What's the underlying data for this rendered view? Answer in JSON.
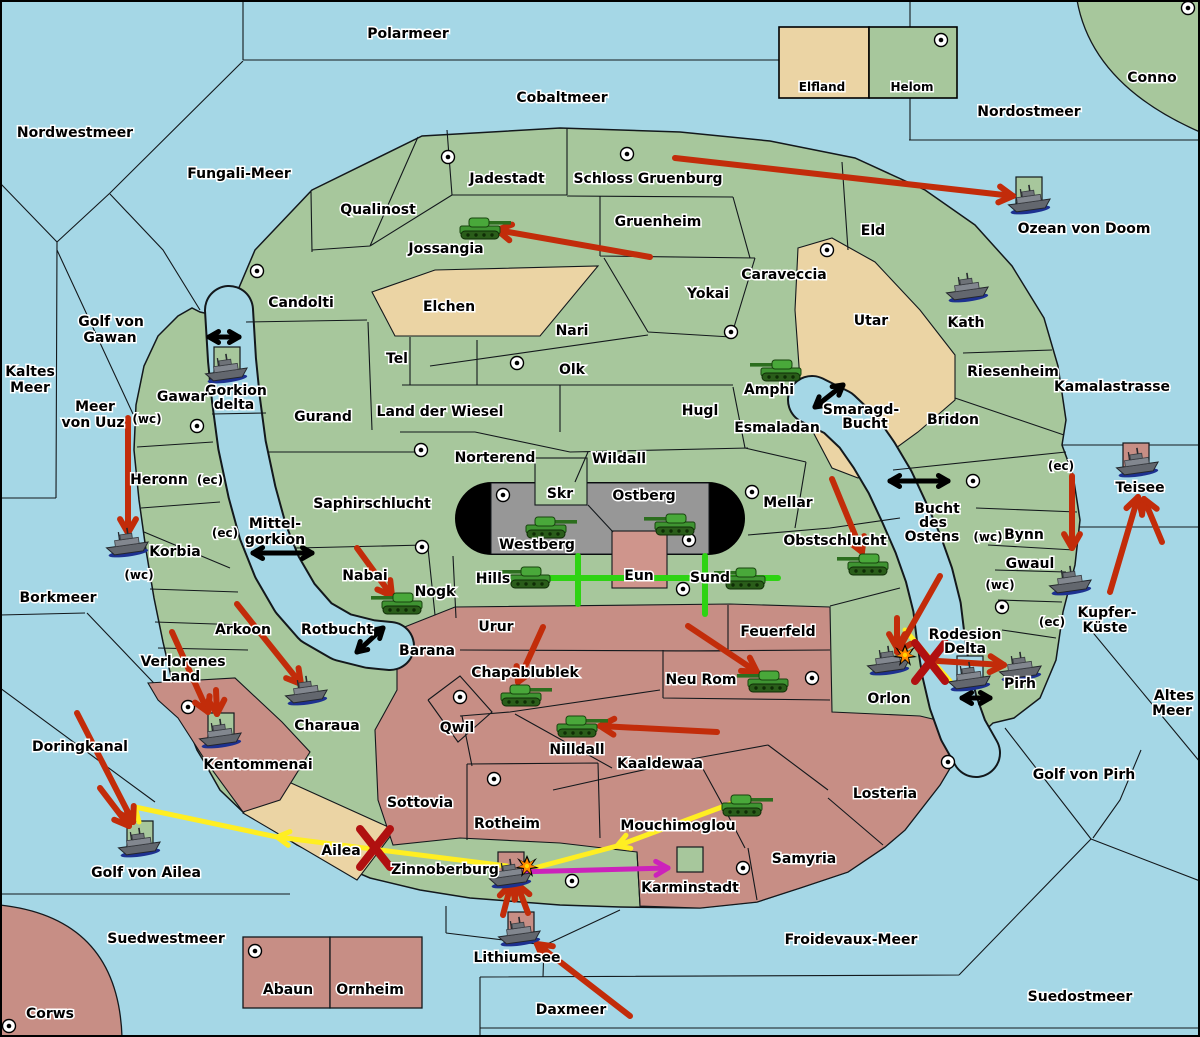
{
  "map_name": "territory-war-map",
  "colors": {
    "sea": "#a5d7e6",
    "land": "#a7c79c",
    "tan": "#ebd4a4",
    "pink": "#c78e85",
    "gray": "#979797",
    "eun": "#cf958c",
    "black": "#000000",
    "red_arrow": "#c22c0a",
    "dark_red": "#b01010",
    "yellow": "#ffee22",
    "magenta": "#cc22bb",
    "green_line": "#2ed313",
    "explosion": "#ff8800"
  },
  "legend": {
    "items": [
      {
        "label": "Elfland",
        "color": "#ebd4a4"
      },
      {
        "label": "Helom",
        "color": "#a7c79c",
        "has_marker": true
      }
    ]
  },
  "labels": [
    {
      "n": "polarmeer",
      "t": "Polarmeer",
      "x": 408,
      "y": 38
    },
    {
      "n": "nordwestmeer",
      "t": "Nordwestmeer",
      "x": 75,
      "y": 137
    },
    {
      "n": "cobaltmeer",
      "t": "Cobaltmeer",
      "x": 562,
      "y": 102
    },
    {
      "n": "nordostmeer",
      "t": "Nordostmeer",
      "x": 1029,
      "y": 116
    },
    {
      "n": "conno",
      "t": "Conno",
      "x": 1152,
      "y": 82
    },
    {
      "n": "fungali-meer",
      "t": "Fungali-Meer",
      "x": 239,
      "y": 178
    },
    {
      "n": "ozean-von-doom",
      "t": "Ozean von Doom",
      "x": 1084,
      "y": 233
    },
    {
      "n": "golf-von-gawan-1",
      "t": "Golf von",
      "x": 111,
      "y": 326
    },
    {
      "n": "golf-von-gawan-2",
      "t": "Gawan",
      "x": 110,
      "y": 342
    },
    {
      "n": "kaltes-meer-1",
      "t": "Kaltes",
      "x": 30,
      "y": 376
    },
    {
      "n": "kaltes-meer-2",
      "t": "Meer",
      "x": 30,
      "y": 392
    },
    {
      "n": "meer-von-uuz-1",
      "t": "Meer",
      "x": 95,
      "y": 411
    },
    {
      "n": "meer-von-uuz-2",
      "t": "von Uuz",
      "x": 93,
      "y": 427
    },
    {
      "n": "borkmeer",
      "t": "Borkmeer",
      "x": 58,
      "y": 602
    },
    {
      "n": "mittelgorkion-1",
      "t": "Mittel-",
      "x": 275,
      "y": 528
    },
    {
      "n": "mittelgorkion-2",
      "t": "gorkion",
      "x": 275,
      "y": 544
    },
    {
      "n": "rotbucht",
      "t": "Rotbucht",
      "x": 337,
      "y": 634
    },
    {
      "n": "doringkanal",
      "t": "Doringkanal",
      "x": 80,
      "y": 751
    },
    {
      "n": "golf-von-ailea",
      "t": "Golf von Ailea",
      "x": 146,
      "y": 877
    },
    {
      "n": "suedwestmeer",
      "t": "Suedwestmeer",
      "x": 166,
      "y": 943
    },
    {
      "n": "corws",
      "t": "Corws",
      "x": 50,
      "y": 1018
    },
    {
      "n": "suedostmeer",
      "t": "Suedostmeer",
      "x": 1080,
      "y": 1001
    },
    {
      "n": "froidevaux-meer",
      "t": "Froidevaux-Meer",
      "x": 851,
      "y": 944
    },
    {
      "n": "daxmeer",
      "t": "Daxmeer",
      "x": 571,
      "y": 1014
    },
    {
      "n": "lithiumsee",
      "t": "Lithiumsee",
      "x": 517,
      "y": 962
    },
    {
      "n": "kamalastrasse",
      "t": "Kamalastrasse",
      "x": 1112,
      "y": 391
    },
    {
      "n": "kupfer-kueste-1",
      "t": "Kupfer-",
      "x": 1107,
      "y": 617
    },
    {
      "n": "kupfer-kueste-2",
      "t": "Küste",
      "x": 1105,
      "y": 632
    },
    {
      "n": "altes-meer-1",
      "t": "Altes",
      "x": 1174,
      "y": 700
    },
    {
      "n": "altes-meer-2",
      "t": "Meer",
      "x": 1172,
      "y": 715
    },
    {
      "n": "golf-von-pirh",
      "t": "Golf von Pirh",
      "x": 1084,
      "y": 779
    },
    {
      "n": "bucht-des-ostens-1",
      "t": "Bucht",
      "x": 937,
      "y": 513
    },
    {
      "n": "bucht-des-ostens-2",
      "t": "des",
      "x": 933,
      "y": 527
    },
    {
      "n": "bucht-des-ostens-3",
      "t": "Ostens",
      "x": 932,
      "y": 541
    },
    {
      "n": "smaragd-bucht-1",
      "t": "Smaragd-",
      "x": 861,
      "y": 414
    },
    {
      "n": "smaragd-bucht-2",
      "t": "Bucht",
      "x": 865,
      "y": 428
    },
    {
      "n": "gorkion-delta-1",
      "t": "Gorkion",
      "x": 236,
      "y": 395
    },
    {
      "n": "gorkion-delta-2",
      "t": "delta",
      "x": 234,
      "y": 409
    },
    {
      "n": "teisee",
      "t": "Teisee",
      "x": 1140,
      "y": 492
    },
    {
      "n": "qualinost",
      "t": "Qualinost",
      "x": 378,
      "y": 214
    },
    {
      "n": "jadestadt",
      "t": "Jadestadt",
      "x": 507,
      "y": 183
    },
    {
      "n": "schloss-gruenburg",
      "t": "Schloss Gruenburg",
      "x": 648,
      "y": 183
    },
    {
      "n": "gruenheim",
      "t": "Gruenheim",
      "x": 658,
      "y": 226
    },
    {
      "n": "jossangia",
      "t": "Jossangia",
      "x": 446,
      "y": 253
    },
    {
      "n": "candolti",
      "t": "Candolti",
      "x": 301,
      "y": 307
    },
    {
      "n": "eld",
      "t": "Eld",
      "x": 873,
      "y": 235
    },
    {
      "n": "caraveccia",
      "t": "Caraveccia",
      "x": 784,
      "y": 279
    },
    {
      "n": "yokai",
      "t": "Yokai",
      "x": 708,
      "y": 298
    },
    {
      "n": "utar",
      "t": "Utar",
      "x": 871,
      "y": 325
    },
    {
      "n": "kath",
      "t": "Kath",
      "x": 966,
      "y": 327
    },
    {
      "n": "elchen",
      "t": "Elchen",
      "x": 449,
      "y": 311
    },
    {
      "n": "nari",
      "t": "Nari",
      "x": 572,
      "y": 335
    },
    {
      "n": "tel",
      "t": "Tel",
      "x": 397,
      "y": 363
    },
    {
      "n": "olk",
      "t": "Olk",
      "x": 572,
      "y": 374
    },
    {
      "n": "riesenheim",
      "t": "Riesenheim",
      "x": 1013,
      "y": 376
    },
    {
      "n": "bridon",
      "t": "Bridon",
      "x": 953,
      "y": 424
    },
    {
      "n": "gurand",
      "t": "Gurand",
      "x": 323,
      "y": 421
    },
    {
      "n": "land-der-wiesel",
      "t": "Land der Wiesel",
      "x": 440,
      "y": 416
    },
    {
      "n": "gawar",
      "t": "Gawar",
      "x": 182,
      "y": 401
    },
    {
      "n": "heronn",
      "t": "Heronn",
      "x": 159,
      "y": 484
    },
    {
      "n": "korbia",
      "t": "Korbia",
      "x": 175,
      "y": 556
    },
    {
      "n": "norterend",
      "t": "Norterend",
      "x": 495,
      "y": 462
    },
    {
      "n": "wildall",
      "t": "Wildall",
      "x": 619,
      "y": 463
    },
    {
      "n": "hugl",
      "t": "Hugl",
      "x": 700,
      "y": 415
    },
    {
      "n": "amphi",
      "t": "Amphi",
      "x": 769,
      "y": 394
    },
    {
      "n": "esmaladan",
      "t": "Esmaladan",
      "x": 777,
      "y": 432
    },
    {
      "n": "mellar",
      "t": "Mellar",
      "x": 788,
      "y": 507
    },
    {
      "n": "skr",
      "t": "Skr",
      "x": 560,
      "y": 498
    },
    {
      "n": "ostberg",
      "t": "Ostberg",
      "x": 644,
      "y": 500
    },
    {
      "n": "westberg",
      "t": "Westberg",
      "x": 537,
      "y": 549
    },
    {
      "n": "hills",
      "t": "Hills",
      "x": 493,
      "y": 583
    },
    {
      "n": "eun",
      "t": "Eun",
      "x": 639,
      "y": 580
    },
    {
      "n": "sund",
      "t": "Sund",
      "x": 710,
      "y": 582
    },
    {
      "n": "obstschlucht",
      "t": "Obstschlucht",
      "x": 835,
      "y": 545
    },
    {
      "n": "saphirschlucht",
      "t": "Saphirschlucht",
      "x": 372,
      "y": 508
    },
    {
      "n": "nabai",
      "t": "Nabai",
      "x": 365,
      "y": 580
    },
    {
      "n": "nogk",
      "t": "Nogk",
      "x": 435,
      "y": 596
    },
    {
      "n": "barana",
      "t": "Barana",
      "x": 427,
      "y": 655
    },
    {
      "n": "arkoon",
      "t": "Arkoon",
      "x": 243,
      "y": 634
    },
    {
      "n": "verlorenes-land-1",
      "t": "Verlorenes",
      "x": 183,
      "y": 666
    },
    {
      "n": "verlorenes-land-2",
      "t": "Land",
      "x": 181,
      "y": 681
    },
    {
      "n": "charaua",
      "t": "Charaua",
      "x": 327,
      "y": 730
    },
    {
      "n": "urur",
      "t": "Urur",
      "x": 496,
      "y": 631
    },
    {
      "n": "chapablublek",
      "t": "Chapablublek",
      "x": 525,
      "y": 677
    },
    {
      "n": "feuerfeld",
      "t": "Feuerfeld",
      "x": 778,
      "y": 636
    },
    {
      "n": "neu-rom",
      "t": "Neu Rom",
      "x": 701,
      "y": 684
    },
    {
      "n": "qwil",
      "t": "Qwil",
      "x": 457,
      "y": 732
    },
    {
      "n": "nilldall",
      "t": "Nilldall",
      "x": 577,
      "y": 754
    },
    {
      "n": "kaaldewaa",
      "t": "Kaaldewaa",
      "x": 660,
      "y": 768
    },
    {
      "n": "sottovia",
      "t": "Sottovia",
      "x": 420,
      "y": 807
    },
    {
      "n": "rotheim",
      "t": "Rotheim",
      "x": 507,
      "y": 828
    },
    {
      "n": "mouchimoglou",
      "t": "Mouchimoglou",
      "x": 678,
      "y": 830
    },
    {
      "n": "ailea",
      "t": "Ailea",
      "x": 341,
      "y": 855
    },
    {
      "n": "zinnoberburg",
      "t": "Zinnoberburg",
      "x": 445,
      "y": 874
    },
    {
      "n": "karminstadt",
      "t": "Karminstadt",
      "x": 690,
      "y": 892
    },
    {
      "n": "samyria",
      "t": "Samyria",
      "x": 804,
      "y": 863
    },
    {
      "n": "kentommenai",
      "t": "Kentommenai",
      "x": 258,
      "y": 769
    },
    {
      "n": "losteria",
      "t": "Losteria",
      "x": 885,
      "y": 798
    },
    {
      "n": "abaun",
      "t": "Abaun",
      "x": 288,
      "y": 994
    },
    {
      "n": "ornheim",
      "t": "Ornheim",
      "x": 370,
      "y": 994
    },
    {
      "n": "orlon",
      "t": "Orlon",
      "x": 889,
      "y": 703
    },
    {
      "n": "bynn",
      "t": "Bynn",
      "x": 1024,
      "y": 539
    },
    {
      "n": "gwaul",
      "t": "Gwaul",
      "x": 1030,
      "y": 568
    },
    {
      "n": "pirh",
      "t": "Pirh",
      "x": 1020,
      "y": 688
    },
    {
      "n": "rodesion-delta-1",
      "t": "Rodesion",
      "x": 965,
      "y": 639
    },
    {
      "n": "rodesion-delta-2",
      "t": "Delta",
      "x": 965,
      "y": 653
    },
    {
      "n": "legend-elfland",
      "t": "Elfland",
      "x": 822,
      "y": 91,
      "s": 1
    },
    {
      "n": "legend-helom",
      "t": "Helom",
      "x": 912,
      "y": 91,
      "s": 1
    },
    {
      "n": "wc-gawar",
      "t": "(wc)",
      "x": 147,
      "y": 423,
      "s": 1
    },
    {
      "n": "ec-heronn",
      "t": "(ec)",
      "x": 210,
      "y": 484,
      "s": 1
    },
    {
      "n": "ec-korbia",
      "t": "(ec)",
      "x": 225,
      "y": 537,
      "s": 1
    },
    {
      "n": "wc-korbia",
      "t": "(wc)",
      "x": 139,
      "y": 579,
      "s": 1
    },
    {
      "n": "ec-bynn-north",
      "t": "(ec)",
      "x": 1061,
      "y": 470,
      "s": 1
    },
    {
      "n": "wc-bynn",
      "t": "(wc)",
      "x": 988,
      "y": 541,
      "s": 1
    },
    {
      "n": "wc-gwaul",
      "t": "(wc)",
      "x": 1000,
      "y": 589,
      "s": 1
    },
    {
      "n": "ec-pirh",
      "t": "(ec)",
      "x": 1052,
      "y": 626,
      "s": 1
    }
  ],
  "units": {
    "tanks": [
      {
        "n": "tank-jossangia",
        "x": 480,
        "y": 228,
        "f": 1
      },
      {
        "n": "tank-amphi",
        "x": 781,
        "y": 370,
        "f": 0
      },
      {
        "n": "tank-westberg",
        "x": 546,
        "y": 527,
        "f": 1
      },
      {
        "n": "tank-ostberg",
        "x": 675,
        "y": 524,
        "f": 0
      },
      {
        "n": "tank-hills",
        "x": 530,
        "y": 577,
        "f": 0
      },
      {
        "n": "tank-sund",
        "x": 745,
        "y": 578,
        "f": 0
      },
      {
        "n": "tank-obstschlucht",
        "x": 868,
        "y": 564,
        "f": 0
      },
      {
        "n": "tank-nogk",
        "x": 402,
        "y": 603,
        "f": 0
      },
      {
        "n": "tank-chapablublek",
        "x": 521,
        "y": 695,
        "f": 1
      },
      {
        "n": "tank-neu-rom",
        "x": 768,
        "y": 681,
        "f": 0
      },
      {
        "n": "tank-nilldall",
        "x": 577,
        "y": 726,
        "f": 1
      },
      {
        "n": "tank-mouchimoglou",
        "x": 742,
        "y": 805,
        "f": 1
      }
    ],
    "ships": [
      {
        "n": "ship-ozean-von-doom",
        "x": 1029,
        "y": 200
      },
      {
        "n": "ship-gorkion-delta",
        "x": 226,
        "y": 369
      },
      {
        "n": "ship-kath",
        "x": 967,
        "y": 288
      },
      {
        "n": "ship-korbia",
        "x": 127,
        "y": 543
      },
      {
        "n": "ship-charaua",
        "x": 306,
        "y": 691
      },
      {
        "n": "ship-kentommenai",
        "x": 220,
        "y": 734
      },
      {
        "n": "ship-teisee",
        "x": 1137,
        "y": 463
      },
      {
        "n": "ship-gwaul",
        "x": 1070,
        "y": 581
      },
      {
        "n": "ship-rodesion-delta",
        "x": 969,
        "y": 677
      },
      {
        "n": "ship-pirh",
        "x": 1020,
        "y": 667
      },
      {
        "n": "ship-orlon",
        "x": 888,
        "y": 661
      },
      {
        "n": "ship-zinnoberburg",
        "x": 510,
        "y": 874
      },
      {
        "n": "ship-lithiumsee",
        "x": 519,
        "y": 932
      },
      {
        "n": "ship-golf-ailea",
        "x": 139,
        "y": 843
      }
    ]
  },
  "unit_boxes": [
    {
      "n": "box-ozean-von-doom",
      "x": 1016,
      "y": 177,
      "w": 26,
      "h": 26,
      "c": "land"
    },
    {
      "n": "box-gorkion-delta",
      "x": 214,
      "y": 347,
      "w": 26,
      "h": 26,
      "c": "land"
    },
    {
      "n": "box-golf-ailea",
      "x": 127,
      "y": 821,
      "w": 26,
      "h": 25,
      "c": "land"
    },
    {
      "n": "box-kentommenai",
      "x": 208,
      "y": 713,
      "w": 26,
      "h": 25,
      "c": "land"
    },
    {
      "n": "box-karminstadt",
      "x": 677,
      "y": 847,
      "w": 26,
      "h": 25,
      "c": "land"
    },
    {
      "n": "box-rodesion",
      "x": 957,
      "y": 656,
      "w": 26,
      "h": 25,
      "c": "sea"
    },
    {
      "n": "box-teisee",
      "x": 1123,
      "y": 443,
      "w": 26,
      "h": 25,
      "c": "pink"
    },
    {
      "n": "box-zinnoberburg",
      "x": 498,
      "y": 852,
      "w": 26,
      "h": 25,
      "c": "pink"
    },
    {
      "n": "box-lithiumsee",
      "x": 508,
      "y": 912,
      "w": 26,
      "h": 25,
      "c": "pink"
    }
  ],
  "city_markers": [
    [
      448,
      157
    ],
    [
      627,
      154
    ],
    [
      941,
      40
    ],
    [
      1188,
      8
    ],
    [
      257,
      271
    ],
    [
      517,
      363
    ],
    [
      731,
      332
    ],
    [
      827,
      250
    ],
    [
      421,
      450
    ],
    [
      503,
      495
    ],
    [
      689,
      540
    ],
    [
      683,
      589
    ],
    [
      422,
      547
    ],
    [
      460,
      697
    ],
    [
      973,
      481
    ],
    [
      1002,
      607
    ],
    [
      812,
      678
    ],
    [
      752,
      492
    ],
    [
      188,
      707
    ],
    [
      572,
      881
    ],
    [
      743,
      868
    ],
    [
      948,
      762
    ],
    [
      255,
      951
    ],
    [
      9,
      1026
    ],
    [
      197,
      426
    ],
    [
      494,
      779
    ]
  ],
  "arrows": {
    "red": [
      [
        675,
        158,
        1013,
        196
      ],
      [
        650,
        257,
        497,
        230
      ],
      [
        128,
        418,
        128,
        533
      ],
      [
        172,
        632,
        208,
        712
      ],
      [
        216,
        690,
        217,
        714
      ],
      [
        237,
        604,
        301,
        684
      ],
      [
        357,
        548,
        392,
        596
      ],
      [
        543,
        627,
        518,
        682
      ],
      [
        832,
        479,
        862,
        552
      ],
      [
        688,
        626,
        757,
        672
      ],
      [
        717,
        732,
        600,
        726
      ],
      [
        1072,
        476,
        1072,
        548
      ],
      [
        1110,
        592,
        1138,
        497
      ],
      [
        1162,
        542,
        1144,
        499
      ],
      [
        940,
        576,
        897,
        652
      ],
      [
        897,
        618,
        897,
        648
      ],
      [
        938,
        661,
        1004,
        665
      ],
      [
        630,
        1016,
        537,
        944
      ],
      [
        503,
        915,
        511,
        884
      ],
      [
        528,
        913,
        517,
        884
      ],
      [
        77,
        713,
        133,
        822
      ],
      [
        100,
        788,
        129,
        826
      ]
    ],
    "yellow": [
      [
        738,
        801,
        617,
        846,
        1
      ],
      [
        617,
        846,
        523,
        871,
        0
      ],
      [
        507,
        866,
        277,
        837,
        1
      ],
      [
        277,
        837,
        135,
        807,
        0
      ],
      [
        135,
        807,
        139,
        822,
        0
      ],
      [
        905,
        630,
        950,
        681,
        0
      ]
    ],
    "magenta": [
      [
        516,
        872,
        668,
        868,
        1
      ]
    ],
    "green_lines": [
      [
        520,
        578,
        778,
        578
      ],
      [
        578,
        556,
        578,
        604
      ],
      [
        705,
        556,
        705,
        614
      ]
    ],
    "double_black": [
      [
        209,
        337,
        239,
        337
      ],
      [
        253,
        553,
        312,
        553
      ],
      [
        815,
        407,
        843,
        385
      ],
      [
        890,
        481,
        948,
        481
      ],
      [
        357,
        652,
        383,
        628
      ],
      [
        962,
        698,
        990,
        698
      ]
    ],
    "x_marks": [
      [
        930,
        662
      ],
      [
        375,
        848
      ]
    ],
    "explosions": [
      [
        905,
        655
      ],
      [
        527,
        866
      ]
    ]
  }
}
